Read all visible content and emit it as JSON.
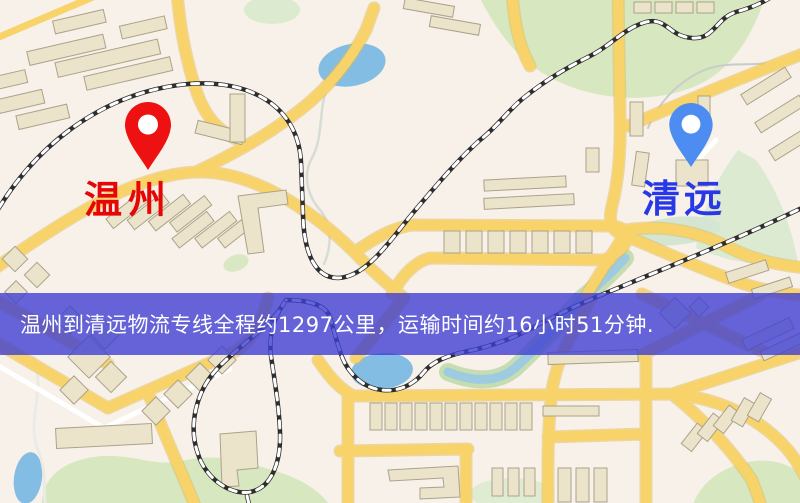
{
  "banner": {
    "text": "温州到清远物流专线全程约1297公里，运输时间约16小时51分钟."
  },
  "markers": {
    "origin": {
      "label": "温州",
      "pin_color": "#ed1111",
      "label_color": "#e60606"
    },
    "destination": {
      "label": "清远",
      "pin_color": "#4d8cf0",
      "label_color": "#2838e6"
    }
  },
  "map": {
    "colors": {
      "land": "#f7f1ea",
      "road": "#f6d36d",
      "road_casing": "#e4ba52",
      "park": "#d7e7c0",
      "water": "#85bde2",
      "building": "#ece4cb",
      "railway": "#2e2e2e",
      "banner_overlay": "rgba(64,64,210,0.8)"
    }
  }
}
